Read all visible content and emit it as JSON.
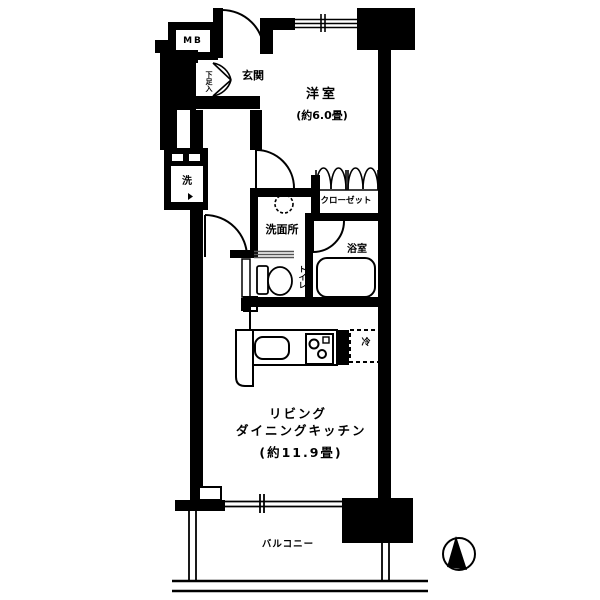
{
  "floorplan": {
    "labels": {
      "meter_box": "MB",
      "entrance": "玄関",
      "shoe_cabinet": "下足入",
      "western_room_name": "洋室",
      "western_room_size": "(約6.0畳)",
      "closet": "クローゼット",
      "washroom": "洗面所",
      "laundry": "洗",
      "bathroom": "浴室",
      "toilet": "トイレ",
      "refrigerator": "冷",
      "ldk_line1": "リビング",
      "ldk_line2": "ダイニングキッチン",
      "ldk_size": "(約11.9畳)",
      "balcony": "バルコニー"
    },
    "icons": {
      "compass": "north-arrow-compass"
    },
    "colors": {
      "wall": "#000000",
      "background": "#ffffff",
      "slider_line": "#555555"
    }
  }
}
